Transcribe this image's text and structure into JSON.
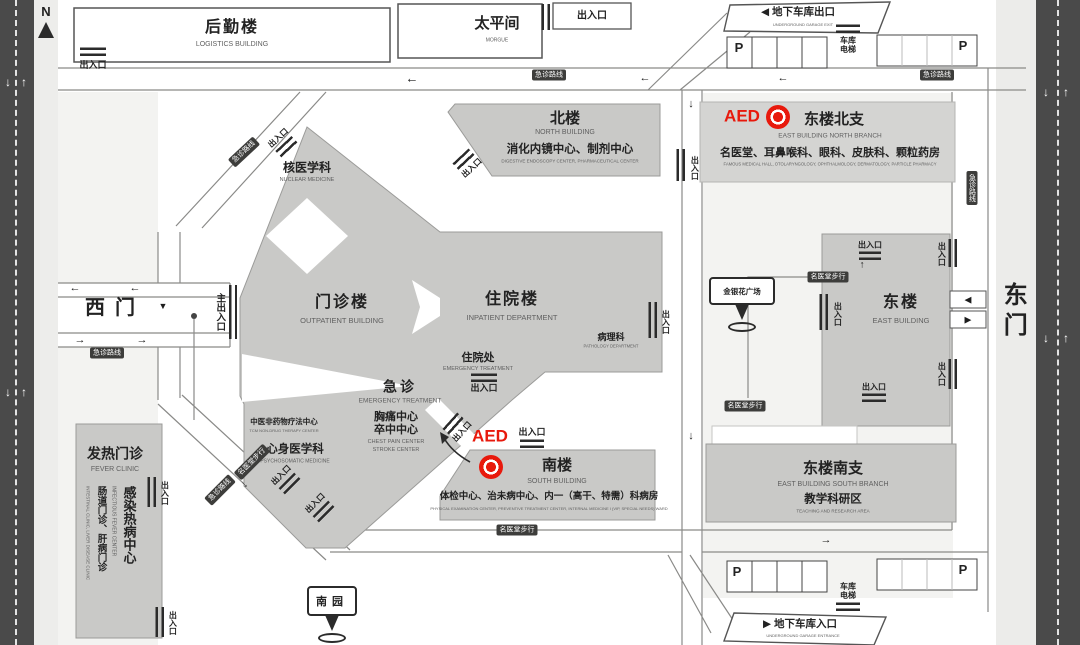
{
  "labels": {
    "entrance_exit": "出入口",
    "main_entrance": "主出入口",
    "emergency_route": "急诊路线",
    "walk_route": "名医堂步行",
    "garage_elevator": "车库电梯",
    "parking": "P",
    "aed": "AED",
    "compass_north": "N"
  },
  "gates": {
    "west": "西门",
    "east": "东门"
  },
  "icons": {
    "arrow_left": "←",
    "arrow_right": "→",
    "arrow_up": "↑",
    "arrow_down": "↓",
    "arrow_left_solid": "◀",
    "arrow_right_solid": "▶",
    "arrow_down_solid": "▼"
  },
  "buildings": {
    "logistics": {
      "name": "后勤楼",
      "en": "LOGISTICS BUILDING"
    },
    "morgue": {
      "name": "太平间",
      "en": "MORGUE"
    },
    "north": {
      "name": "北楼",
      "en": "NORTH BUILDING",
      "depts": "消化内镜中心、制剂中心",
      "depts_en": "DIGESTIVE ENDOSCOPY CENTER, PHARMACEUTICAL CENTER"
    },
    "east_north": {
      "name": "东楼北支",
      "en": "EAST BUILDING NORTH BRANCH",
      "depts": "名医堂、耳鼻喉科、眼科、皮肤科、颗粒药房",
      "depts_en": "FAMOUS MEDICAL HALL, OTOLARYNGOLOGY, OPHTHALMOLOGY, DERMATOLOGY, PARTICLE PHARMACY"
    },
    "east": {
      "name": "东楼",
      "en": "EAST BUILDING"
    },
    "east_south": {
      "name": "东楼南支",
      "en": "EAST BUILDING SOUTH BRANCH",
      "area": "教学科研区",
      "area_en": "TEACHING AND RESEARCH AREA"
    },
    "south": {
      "name": "南楼",
      "en": "SOUTH BUILDING",
      "depts": "体检中心、治未病中心、内一（高干、特需）科病房",
      "depts_en": "PHYSICAL EXAMINATION CENTER, PREVENTIVE TREATMENT CENTER, INTERNAL MEDICINE I (VIP, SPECIAL NEEDS) WARD"
    },
    "fever": {
      "name": "发热门诊",
      "en": "FEVER CLINIC",
      "center": "感染热病中心",
      "center_en": "INFECTIOUS FEVER CENTER",
      "clinics": "肠道门诊、肝病门诊",
      "clinics_en": "INTESTINAL CLINIC, LIVER DISEASE CLINIC"
    },
    "outpatient": {
      "name": "门诊楼",
      "en": "OUTPATIENT BUILDING"
    },
    "inpatient": {
      "name": "住院楼",
      "en": "INPATIENT DEPARTMENT"
    },
    "nuclear": {
      "name": "核医学科",
      "en": "NUCLEAR MEDICINE"
    },
    "pathology": {
      "name": "病理科",
      "en": "PATHOLOGY DEPARTMENT"
    },
    "admission": {
      "name": "住院处",
      "en": "EMERGENCY TREATMENT"
    },
    "emergency": {
      "name": "急诊",
      "en": "EMERGENCY TREATMENT"
    },
    "chest_pain": {
      "name": "胸痛中心",
      "name2": "卒中中心",
      "en": "CHEST PAIN CENTER",
      "en2": "STROKE CENTER"
    },
    "tcm": {
      "name": "中医非药物疗法中心",
      "en": "TCM NON-DRUG THERAPY CENTER"
    },
    "psychosomatic": {
      "name": "心身医学科",
      "en": "PSYCHOSOMATIC MEDICINE"
    }
  },
  "garage": {
    "exit": "地下车库出口",
    "exit_en": "UNDERGROUND GARAGE EXIT",
    "entrance": "地下车库入口",
    "entrance_en": "UNDERGROUND GARAGE ENTRANCE"
  },
  "signposts": {
    "plaza": "金银花广场",
    "garden": "南园"
  },
  "colors": {
    "aed_red": "#e8190c",
    "building_gray": "#c9c9c7",
    "road_dark": "#4a4a4a",
    "badge_dark": "#3d3d3b"
  }
}
